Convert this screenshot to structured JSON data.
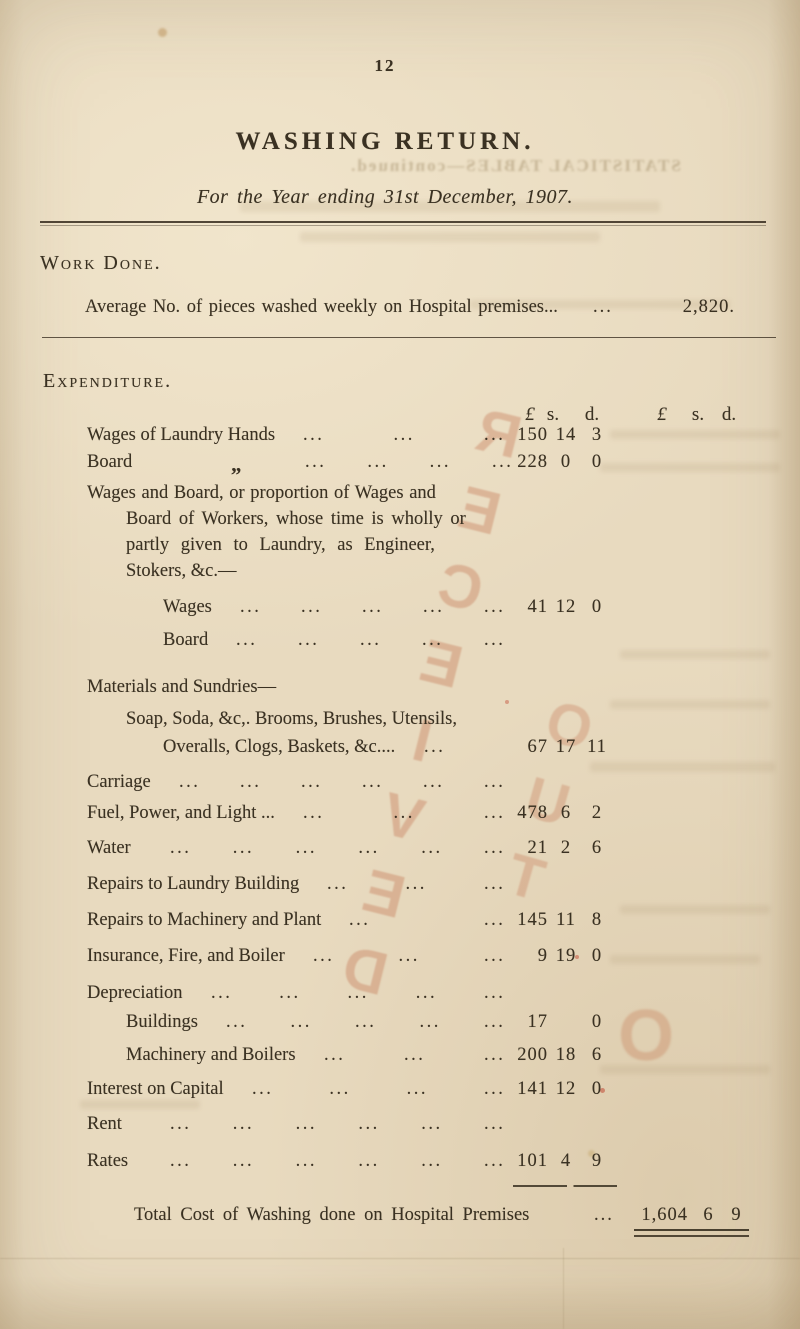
{
  "page_number": "12",
  "title": "WASHING RETURN.",
  "subtitle": "For the Year ending 31st December, 1907.",
  "leader_dots": "...",
  "work_done": {
    "heading": "Work Done.",
    "row": {
      "label": "Average No. of pieces washed weekly on Hospital premises...",
      "value": "2,820."
    }
  },
  "expenditure": {
    "heading": "Expenditure.",
    "money_header": {
      "pound": "£",
      "s": "s.",
      "d": "d."
    },
    "rows": [
      {
        "label": "Wages of Laundry Hands",
        "indent": 1,
        "dots": 3,
        "amount": {
          "p": "150",
          "s": "14",
          "d": "3"
        }
      },
      {
        "label": "Board",
        "indent": 1,
        "ditto": "„",
        "dots": 4,
        "amount": {
          "p": "228",
          "s": "0",
          "d": "0"
        }
      },
      {
        "lines": [
          {
            "text": "Wages and Board, or proportion of Wages and",
            "indent": 1
          },
          {
            "text": "Board of Workers, whose time is wholly or",
            "indent": 2
          },
          {
            "text": "partly given to Laundry, as Engineer,",
            "indent": 2
          },
          {
            "text": "Stokers, &c.—",
            "indent": 2
          }
        ]
      },
      {
        "label": "Wages",
        "indent": 3,
        "dots": 5,
        "amount": {
          "p": "41",
          "s": "12",
          "d": "0"
        }
      },
      {
        "label": "Board",
        "indent": 3,
        "dots": 5
      },
      {
        "label": "Materials and Sundries—",
        "indent": 1,
        "dots": 0
      },
      {
        "label": "Soap, Soda, &c,. Brooms, Brushes, Utensils,",
        "indent": 2,
        "dots": 0
      },
      {
        "label": "Overalls, Clogs, Baskets, &c....",
        "indent": 3,
        "dots": 1,
        "amount": {
          "p": "67",
          "s": "17",
          "d": "11"
        }
      },
      {
        "label": "Carriage",
        "indent": 1,
        "dots": 6
      },
      {
        "label": "Fuel, Power, and Light ...",
        "indent": 1,
        "dots": 3,
        "amount": {
          "p": "478",
          "s": "6",
          "d": "2"
        }
      },
      {
        "label": "Water",
        "indent": 1,
        "dots": 6,
        "amount": {
          "p": "21",
          "s": "2",
          "d": "6"
        }
      },
      {
        "label": "Repairs to Laundry Building",
        "indent": 1,
        "dots": 3
      },
      {
        "label": "Repairs to Machinery and Plant",
        "indent": 1,
        "dots": 2,
        "amount": {
          "p": "145",
          "s": "11",
          "d": "8"
        }
      },
      {
        "label": "Insurance, Fire, and Boiler",
        "indent": 1,
        "dots": 3,
        "amount": {
          "p": "9",
          "s": "19",
          "d": "0"
        }
      },
      {
        "label": "Depreciation",
        "indent": 1,
        "dots": 5
      },
      {
        "label": "Buildings",
        "indent": 2,
        "dots": 5,
        "amount": {
          "p": "17",
          "s": "",
          "d": "0"
        }
      },
      {
        "label": "Machinery and Boilers",
        "indent": 2,
        "dots": 3,
        "amount": {
          "p": "200",
          "s": "18",
          "d": "6"
        }
      },
      {
        "label": "Interest on Capital",
        "indent": 1,
        "dots": 4,
        "amount": {
          "p": "141",
          "s": "12",
          "d": "0"
        }
      },
      {
        "label": "Rent",
        "indent": 1,
        "dots": 6
      },
      {
        "label": "Rates",
        "indent": 1,
        "dots": 6,
        "amount": {
          "p": "101",
          "s": "4",
          "d": "9"
        }
      }
    ],
    "total": {
      "label": "Total Cost of Washing done on Hospital Premises",
      "p": "1,604",
      "s": "6",
      "d": "9"
    }
  },
  "stamp": {
    "text": "RECEIVED",
    "text2": "OUT"
  },
  "bleedthrough": {
    "heading": "STATISTICAL TABLES—continued."
  }
}
